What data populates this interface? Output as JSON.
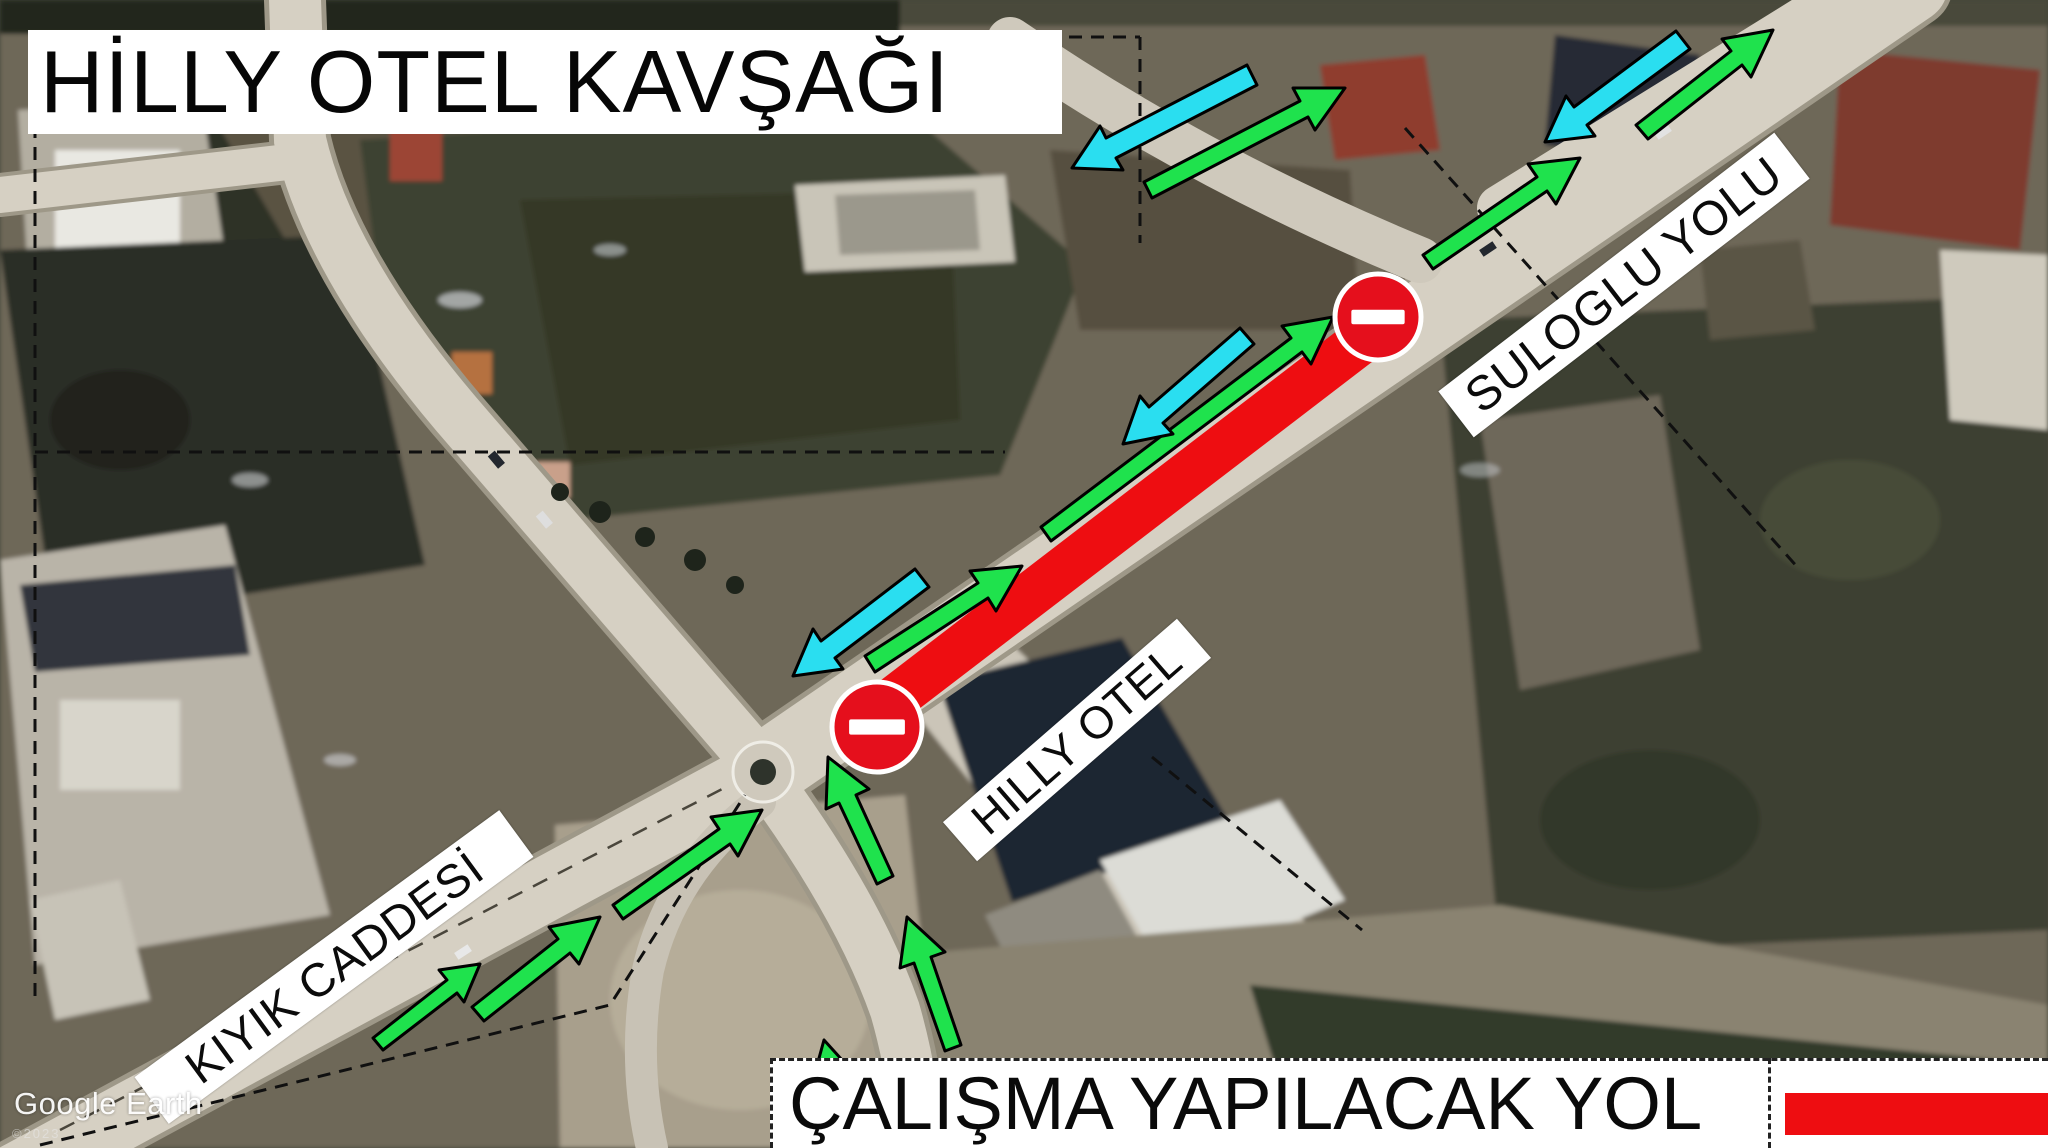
{
  "title": {
    "text": "HİLLY OTEL KAVŞAĞI"
  },
  "watermark": {
    "brand": "Google Earth",
    "fineprint": "©2023"
  },
  "legend": {
    "label": "ÇALIŞMA YAPILACAK YOL",
    "swatch_color": "#ee0d11"
  },
  "road_labels": {
    "kiyik": {
      "text": "KIYIK CADDESİ"
    },
    "hilly": {
      "text": "HILLY OTEL"
    },
    "suloglu": {
      "text": "SULOGLU YOLU"
    }
  },
  "map_annotations": {
    "colors": {
      "open_direction_arrow": "#1fe24d",
      "counter_direction_arrow": "#2adef0",
      "closed_road": "#ee0d11",
      "no_entry_sign": "#e50f1c",
      "boundary_dash": "#101010"
    },
    "closed_road_segment": {
      "x1": 885,
      "y1": 706,
      "x2": 1372,
      "y2": 333,
      "width": 46
    },
    "no_entry_signs": [
      {
        "cx": 877,
        "cy": 727,
        "r": 45
      },
      {
        "cx": 1378,
        "cy": 317,
        "r": 43
      }
    ],
    "green_arrows": [
      {
        "tail": [
          378,
          1044
        ],
        "tip": [
          480,
          964
        ]
      },
      {
        "tail": [
          478,
          1014
        ],
        "tip": [
          600,
          917
        ]
      },
      {
        "tail": [
          618,
          912
        ],
        "tip": [
          762,
          810
        ]
      },
      {
        "tail": [
          885,
          880
        ],
        "tip": [
          828,
          757
        ]
      },
      {
        "tail": [
          953,
          1048
        ],
        "tip": [
          907,
          917
        ]
      },
      {
        "tail": [
          842,
          1118
        ],
        "tip": [
          824,
          1040
        ]
      },
      {
        "tail": [
          870,
          664
        ],
        "tip": [
          1022,
          566
        ]
      },
      {
        "tail": [
          1046,
          534
        ],
        "tip": [
          1333,
          317
        ]
      },
      {
        "tail": [
          1148,
          190
        ],
        "tip": [
          1345,
          88
        ]
      },
      {
        "tail": [
          1428,
          262
        ],
        "tip": [
          1580,
          158
        ]
      },
      {
        "tail": [
          1642,
          132
        ],
        "tip": [
          1773,
          30
        ]
      }
    ],
    "cyan_arrows": [
      {
        "tail": [
          922,
          578
        ],
        "tip": [
          793,
          676
        ]
      },
      {
        "tail": [
          1247,
          336
        ],
        "tip": [
          1123,
          444
        ]
      },
      {
        "tail": [
          1252,
          75
        ],
        "tip": [
          1072,
          168
        ]
      },
      {
        "tail": [
          1683,
          40
        ],
        "tip": [
          1545,
          142
        ]
      }
    ],
    "dashed_boundaries": [
      [
        [
          35,
          37
        ],
        [
          1140,
          37
        ]
      ],
      [
        [
          35,
          37
        ],
        [
          35,
          1005
        ]
      ],
      [
        [
          1140,
          37
        ],
        [
          1140,
          243
        ]
      ],
      [
        [
          35,
          452
        ],
        [
          1005,
          452
        ]
      ],
      [
        [
          1405,
          128
        ],
        [
          1800,
          570
        ]
      ],
      [
        [
          40,
          1145
        ],
        [
          610,
          1005
        ],
        [
          745,
          795
        ]
      ],
      [
        [
          1152,
          757
        ],
        [
          1362,
          930
        ]
      ]
    ]
  }
}
